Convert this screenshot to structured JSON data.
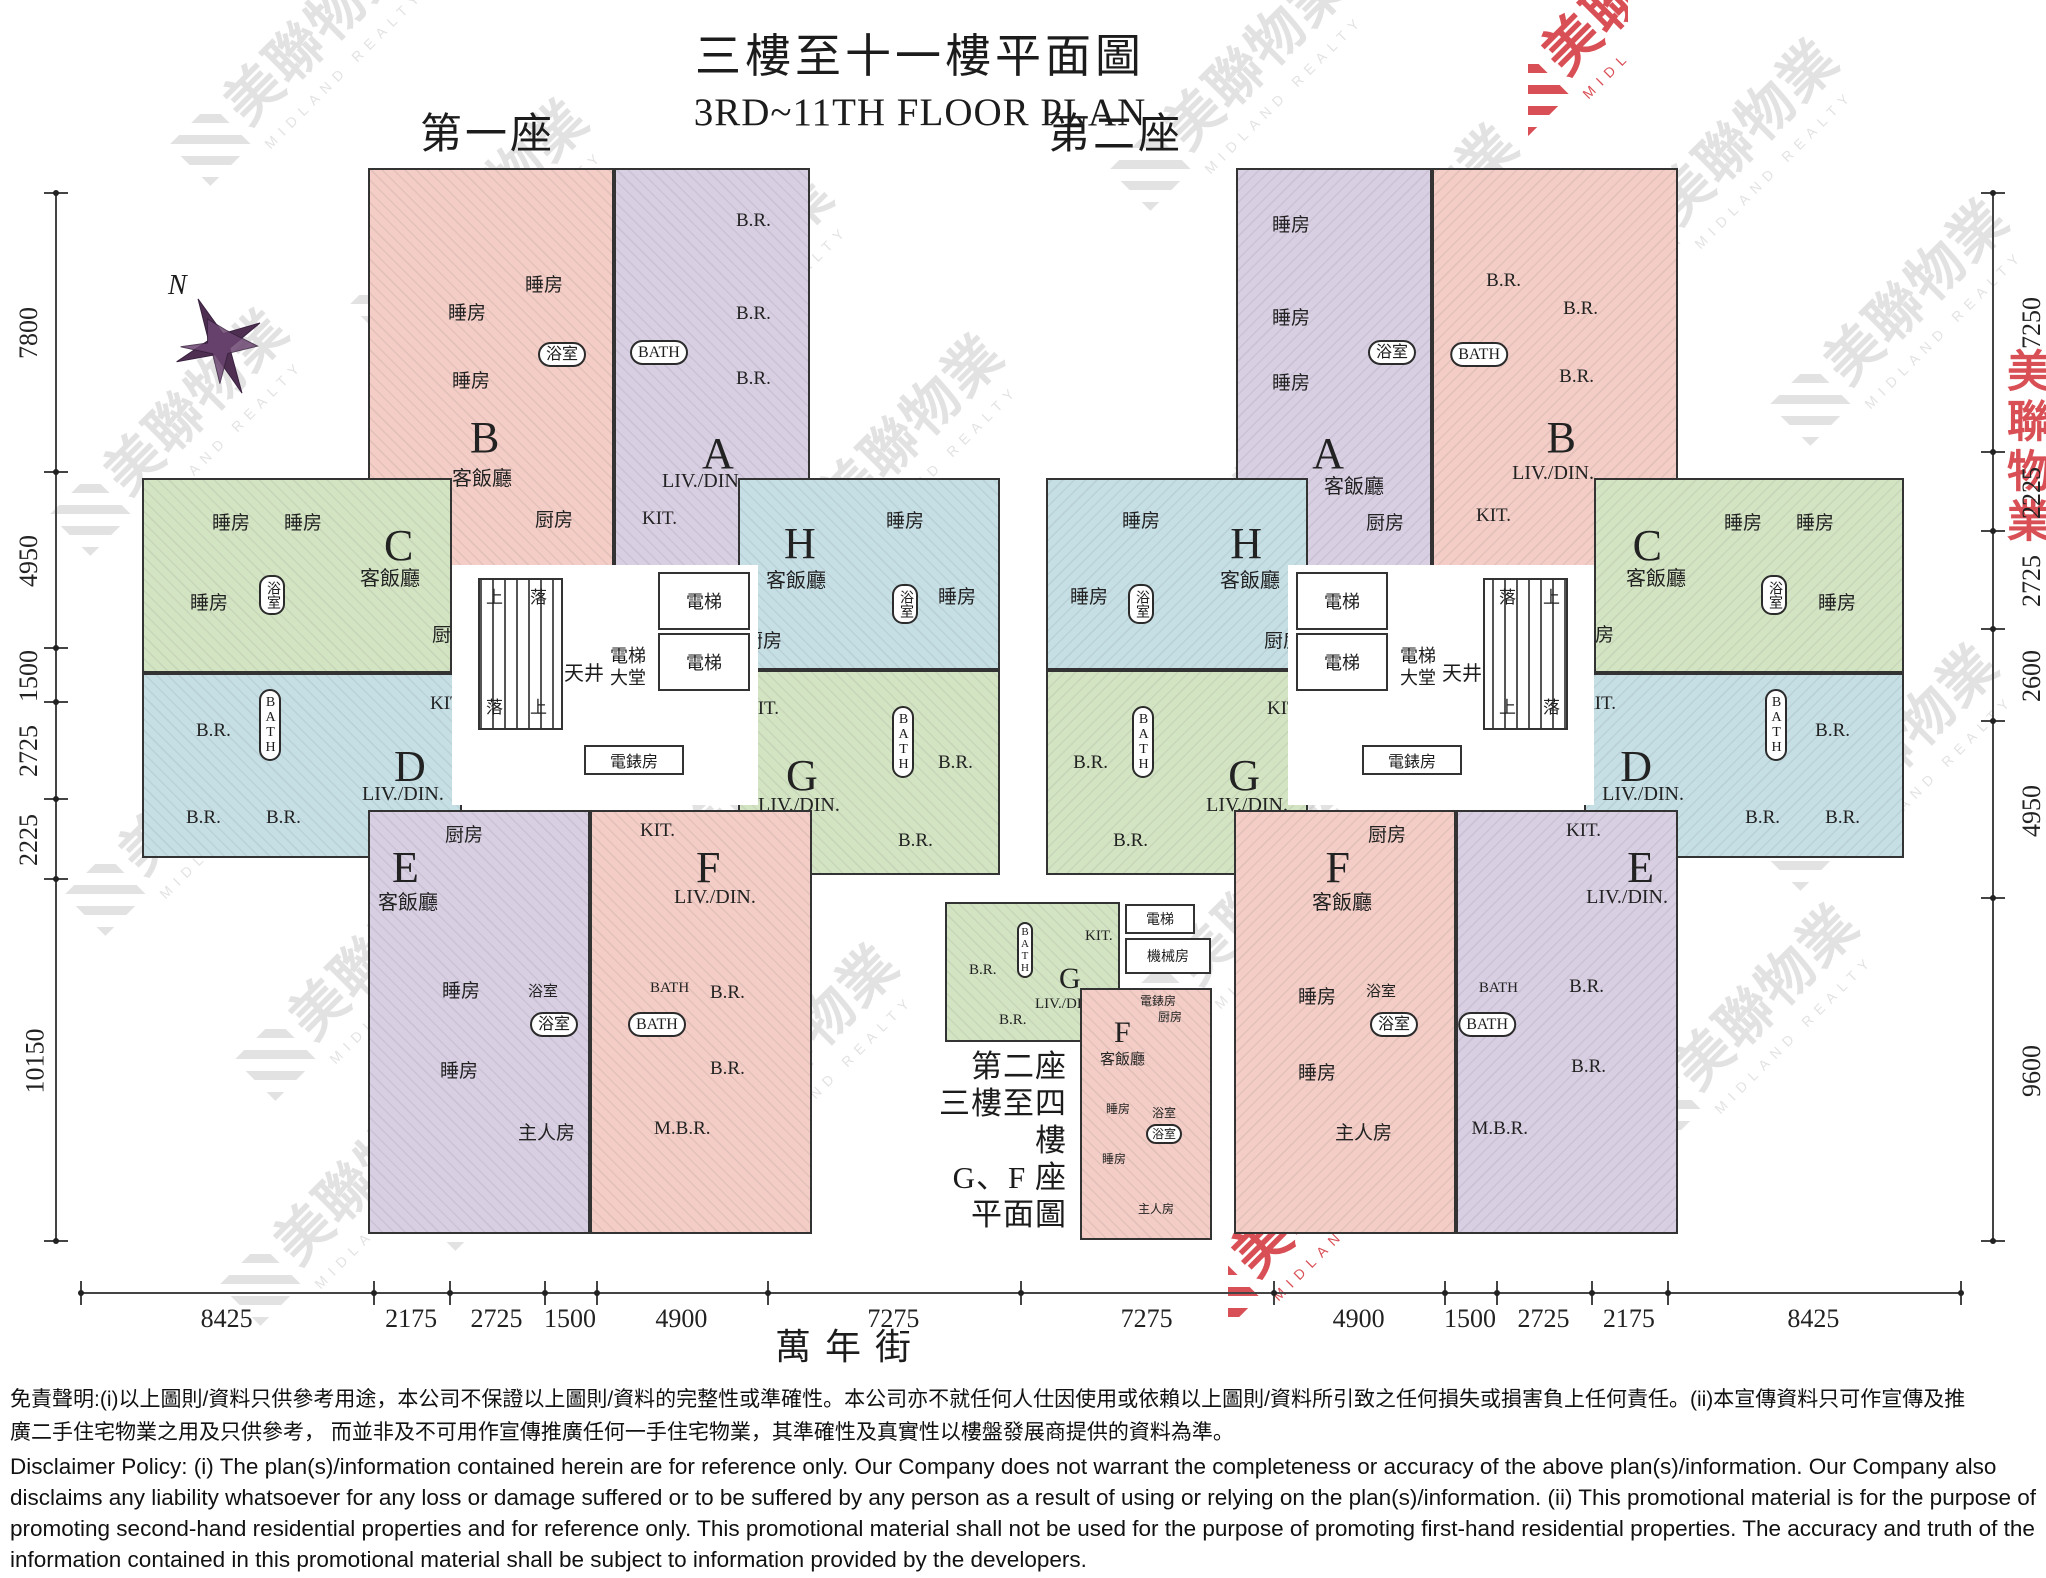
{
  "title": {
    "zh": "三樓至十一樓平面圖",
    "en": "3RD~11TH FLOOR PLAN"
  },
  "block_labels": {
    "tower1": "第一座",
    "tower2": "第二座"
  },
  "compass_n": "N",
  "street_name": "萬年街",
  "watermark": {
    "zh": "美聯物業",
    "en": "MIDLAND REALTY"
  },
  "colors": {
    "pink": "#f3cdc6",
    "purple": "#d8cfe3",
    "green": "#d3e4c3",
    "blue": "#c5dfe5",
    "wall": "#333333",
    "wm_gray": "#c6c6c6",
    "wm_red": "#d0242c"
  },
  "dimensions": {
    "left": [
      "7800",
      "4950",
      "1500",
      "2725",
      "2225",
      "10150"
    ],
    "right": [
      "7250",
      "2225",
      "2725",
      "2600",
      "4950",
      "9600"
    ],
    "bottom": [
      "8425",
      "2175",
      "2725",
      "1500",
      "4900",
      "7275",
      "7275",
      "4900",
      "1500",
      "2725",
      "2175",
      "8425"
    ]
  },
  "core": {
    "up": "上",
    "down": "落",
    "lightwell": "天井",
    "lobby_l1": "電梯",
    "lobby_l2": "大堂",
    "lift": "電梯",
    "meter": "電錶房"
  },
  "towers": {
    "t1": {
      "label": "第一座",
      "units": [
        {
          "letter": "B",
          "name": "客飯廳",
          "bed1": "睡房",
          "bed2": "睡房",
          "bed3": "睡房",
          "bath": "浴室",
          "kitchen": "厨房"
        },
        {
          "letter": "A",
          "name": "LIV./DIN.",
          "bed1": "B.R.",
          "bed2": "B.R.",
          "bed3": "B.R.",
          "bath": "BATH",
          "kitchen": "KIT."
        },
        {
          "letter": "C",
          "name": "客飯廳",
          "bed1": "睡房",
          "bed2": "睡房",
          "bed3": "睡房",
          "bath": "浴室",
          "kitchen": "厨房"
        },
        {
          "letter": "D",
          "name": "LIV./DIN.",
          "bed1": "B.R.",
          "bed2": "B.R.",
          "bed3": "B.R.",
          "bath": "BATH",
          "kitchen": "KIT."
        },
        {
          "letter": "H",
          "name": "客飯廳",
          "bed1": "睡房",
          "bed2": "睡房",
          "bath": "浴室",
          "kitchen": "厨房"
        },
        {
          "letter": "G",
          "name": "LIV./DIN.",
          "bed1": "B.R.",
          "bed2": "B.R.",
          "bath": "BATH",
          "kitchen": "KIT."
        },
        {
          "letter": "E",
          "name": "客飯廳",
          "kitchen": "厨房",
          "bed1": "睡房",
          "bed2": "睡房",
          "bath1": "浴室",
          "bath2": "浴室",
          "master": "主人房"
        },
        {
          "letter": "F",
          "name": "LIV./DIN.",
          "kitchen": "KIT.",
          "bed1": "B.R.",
          "bed2": "B.R.",
          "bath1": "BATH",
          "bath2": "BATH",
          "master": "M.B.R."
        }
      ]
    },
    "t2": {
      "label": "第二座",
      "units": [
        {
          "letter": "B",
          "name": "LIV./DIN.",
          "bed1": "B.R.",
          "bed2": "B.R.",
          "bed3": "B.R.",
          "bath": "BATH",
          "kitchen": "KIT."
        },
        {
          "letter": "A",
          "name": "客飯廳",
          "bed1": "睡房",
          "bed2": "睡房",
          "bed3": "睡房",
          "bath": "浴室",
          "kitchen": "厨房"
        },
        {
          "letter": "C",
          "name": "客飯廳",
          "bed1": "睡房",
          "bed2": "睡房",
          "bed3": "睡房",
          "bath": "浴室",
          "kitchen": "厨房"
        },
        {
          "letter": "D",
          "name": "LIV./DIN.",
          "bed1": "B.R.",
          "bed2": "B.R.",
          "bed3": "B.R.",
          "bath": "BATH",
          "kitchen": "KIT."
        },
        {
          "letter": "H",
          "name": "客飯廳",
          "bed1": "睡房",
          "bed2": "睡房",
          "bath": "浴室",
          "kitchen": "厨房"
        },
        {
          "letter": "G",
          "name": "LIV./DIN.",
          "bed1": "B.R.",
          "bed2": "B.R.",
          "bath": "BATH",
          "kitchen": "KIT."
        },
        {
          "letter": "E",
          "name": "LIV./DIN.",
          "kitchen": "KIT.",
          "bed1": "B.R.",
          "bed2": "B.R.",
          "bath1": "BATH",
          "bath2": "BATH",
          "master": "M.B.R."
        },
        {
          "letter": "F",
          "name": "客飯廳",
          "kitchen": "厨房",
          "bed1": "睡房",
          "bed2": "睡房",
          "bath1": "浴室",
          "bath2": "浴室",
          "master": "主人房"
        }
      ]
    }
  },
  "mini_plan": {
    "caption": [
      "第二座",
      "三樓至四樓",
      "G、F 座平面圖"
    ],
    "lift": "電梯",
    "machine": "機械房",
    "g": {
      "letter": "G",
      "name": "LIV./DIN.",
      "bed1": "B.R.",
      "bed2": "B.R.",
      "bath": "BATH",
      "kitchen": "KIT."
    },
    "f": {
      "letter": "F",
      "name": "客飯廳",
      "meter": "電錶房",
      "kitchen": "厨房",
      "bed1": "睡房",
      "bed2": "睡房",
      "bath1": "浴室",
      "bath2": "浴室",
      "master": "主人房"
    }
  },
  "disclaimer": {
    "zh": [
      "免責聲明:(i)以上圖則/資料只供參考用途，本公司不保證以上圖則/資料的完整性或準確性。本公司亦不就任何人仕因使用或依賴以上圖則/資料所引致之任何損失或損害負上任何責任。(ii)本宣傳資料只可作宣傳及推",
      "廣二手住宅物業之用及只供參考， 而並非及不可用作宣傳推廣任何一手住宅物業，其準確性及真實性以樓盤發展商提供的資料為準。"
    ],
    "en": "Disclaimer Policy: (i) The plan(s)/information contained herein are for reference only. Our Company does not warrant the completeness or accuracy of the above plan(s)/information. Our Company also disclaims any liability whatsoever for any loss or damage suffered or to be suffered by any person as a result of using or relying on the plan(s)/information. (ii) This promotional material is for the purpose of promoting second-hand residential properties and for reference only. This promotional material shall not be used for the purpose of promoting first-hand residential properties. The accuracy and truth of the information contained in this promotional material shall be subject to information provided by the developers."
  }
}
